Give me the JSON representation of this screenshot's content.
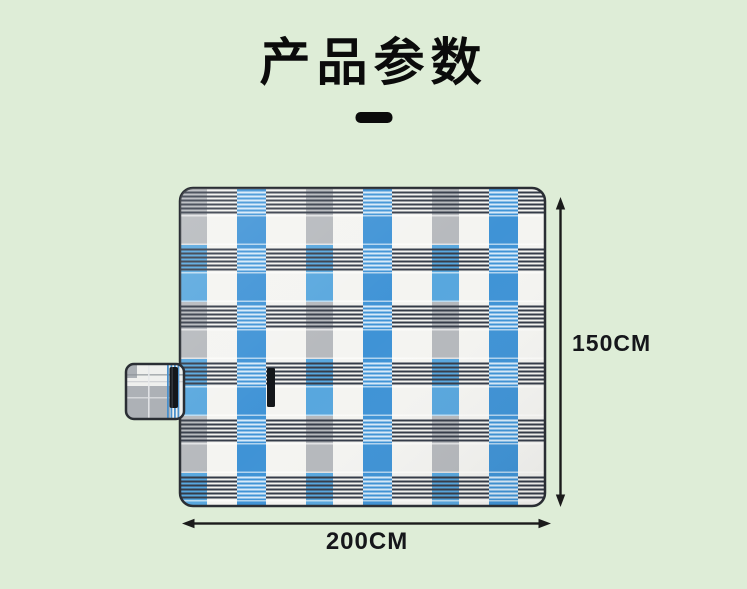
{
  "page": {
    "background_color": "#deedd7"
  },
  "header": {
    "title": "产品参数",
    "divider_color": "#0b0b0b"
  },
  "product_image": {
    "description": "blue, white and gray plaid picnic blanket with fold-over carry handle",
    "colors": {
      "white": "#f4f4f1",
      "blue": "#3f93d6",
      "light_blue": "#58a7de",
      "gray": "#b6b9bd",
      "stripe_dark": "#343b48",
      "stripe_light": "#e8f4fd",
      "trim": "#2a2e34",
      "strap": "#14171b",
      "flap_white": "#eff0ee",
      "flap_gray": "#adb1b6",
      "flap_stripe_blue": "#4a90cc"
    }
  },
  "dimensions": {
    "height": {
      "label": "150CM"
    },
    "width": {
      "label": "200CM"
    },
    "arrow_color": "#1b1b1b"
  }
}
